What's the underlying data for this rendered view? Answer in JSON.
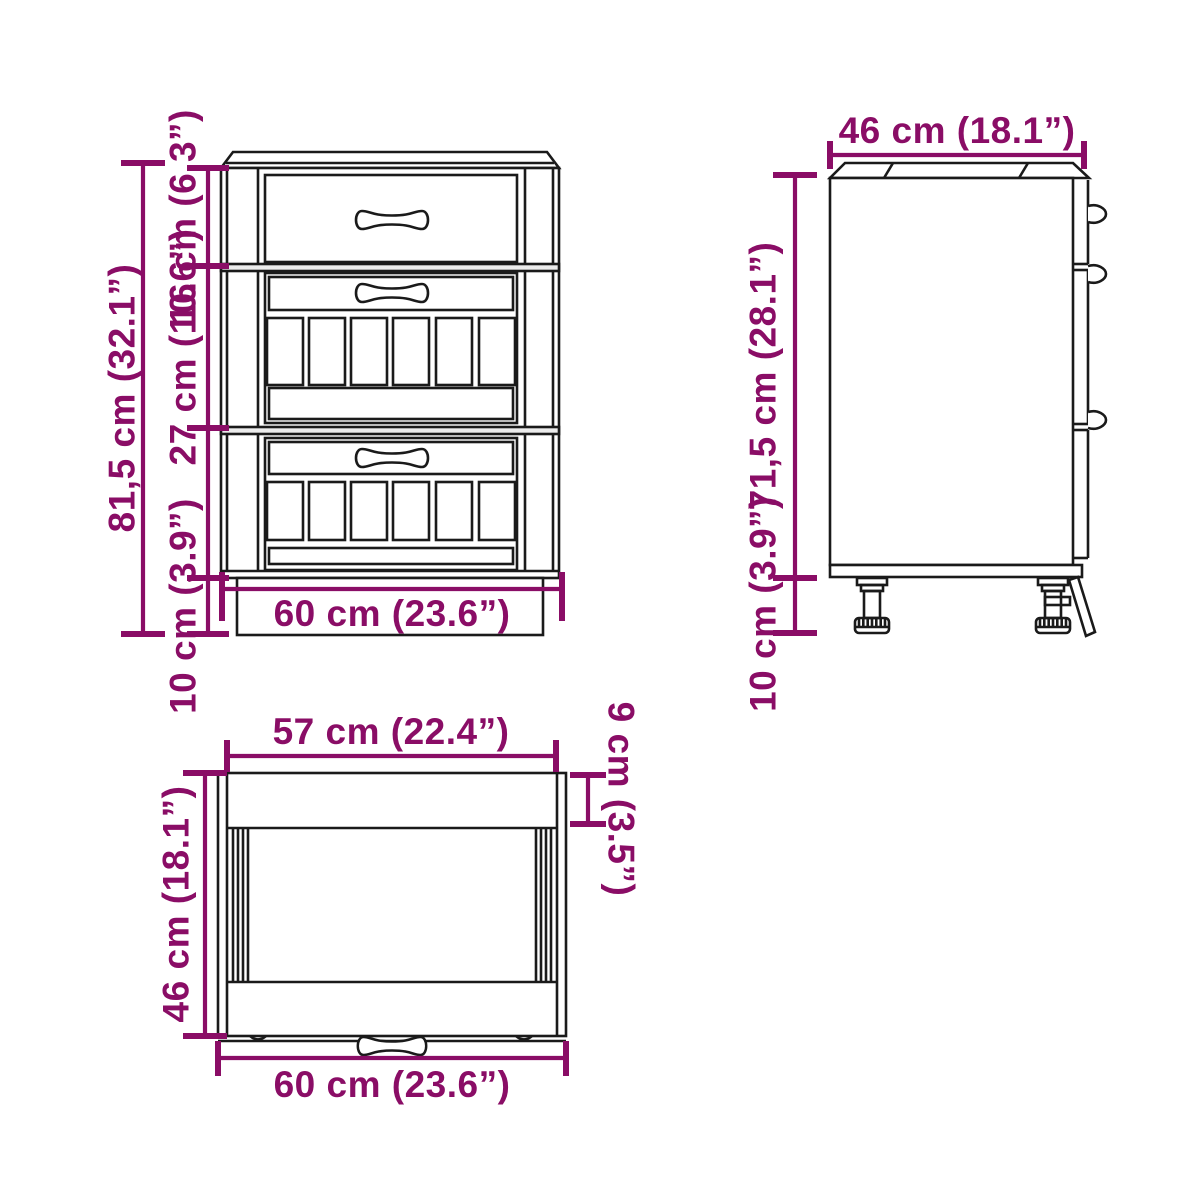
{
  "colors": {
    "bg": "#ffffff",
    "line": "#1a1a1a",
    "accent": "#8a0d66",
    "rail": "#ececec"
  },
  "views": {
    "front": {
      "dims": {
        "total_height": "81,5 cm (32.1”)",
        "top_drawer_height": "16 cm (6.3”)",
        "middle_drawer_height": "27 cm (10.6”)",
        "plinth_height": "10 cm (3.9”)",
        "width": "60 cm (23.6”)"
      }
    },
    "side": {
      "dims": {
        "depth": "46 cm (18.1”)",
        "body_height": "71,5 cm (28.1”)",
        "leg_height": "10 cm (3.9”)"
      }
    },
    "top": {
      "dims": {
        "inner_width": "57 cm (22.4”)",
        "front_rail_depth": "9 cm (3.5”)",
        "depth": "46 cm (18.1”)",
        "width": "60 cm (23.6”)"
      }
    }
  }
}
